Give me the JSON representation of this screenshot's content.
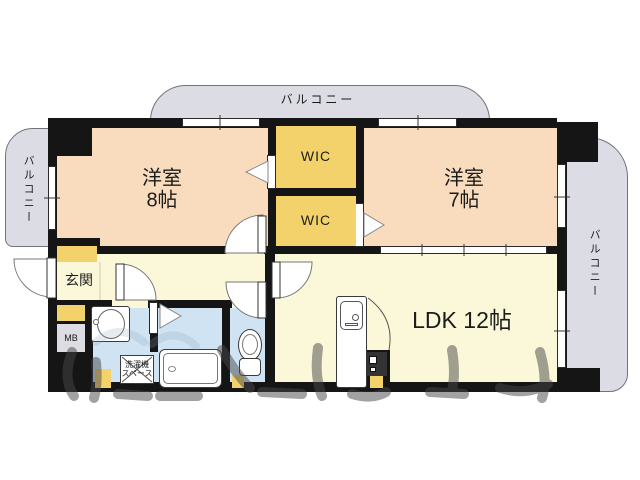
{
  "balconies": {
    "top_label": "バルコニー",
    "left_label": "バルコニー",
    "right_label": "バルコニー"
  },
  "rooms": {
    "bedroom_8": {
      "name": "洋室",
      "size": "8帖"
    },
    "bedroom_7": {
      "name": "洋室",
      "size": "7帖"
    },
    "ldk": {
      "label": "LDK 12帖"
    },
    "wic_upper": {
      "label": "WIC"
    },
    "wic_lower": {
      "label": "WIC"
    },
    "entrance": {
      "label": "玄関"
    },
    "meter_box": {
      "label": "MB"
    },
    "laundry_space": {
      "line1": "洗濯機",
      "line2": "スペース"
    }
  },
  "colors": {
    "wall": "#151515",
    "bedroom_floor": "#f9dcbe",
    "closet": "#f4d26b",
    "living_floor": "#fbf7d9",
    "wet_area_floor": "#cfe3f3",
    "balcony": "#dcdce4",
    "meter_box": "#dcdce2"
  }
}
